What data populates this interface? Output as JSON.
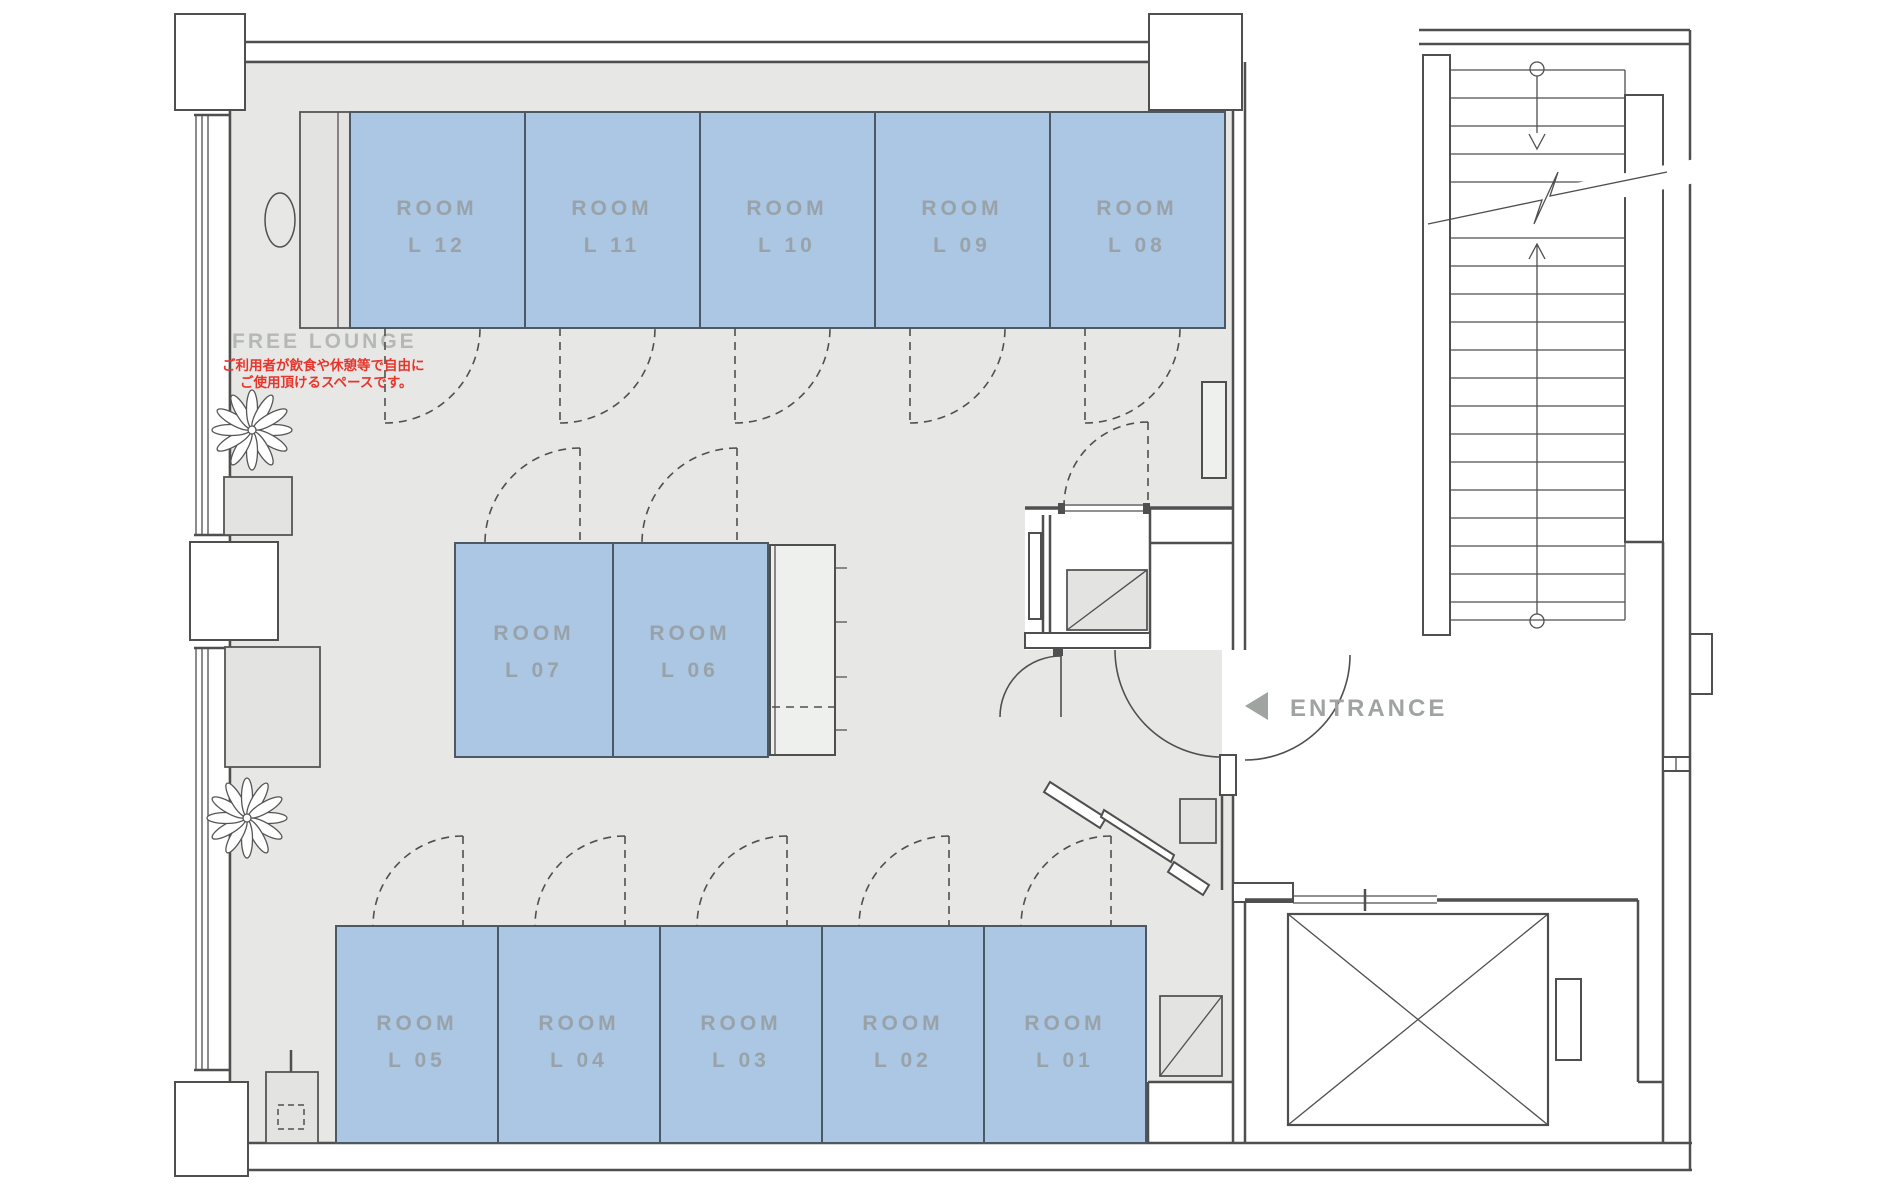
{
  "plan": {
    "type": "floor-plan",
    "free_lounge": {
      "label": "FREE LOUNGE",
      "note_line1": "ご利用者が飲食や休憩等で自由に",
      "note_line2": "ご使用頂けるスペースです。"
    },
    "entrance": {
      "label": "ENTRANCE"
    },
    "rooms": {
      "top": [
        {
          "line1": "ROOM",
          "line2": "L 12"
        },
        {
          "line1": "ROOM",
          "line2": "L 11"
        },
        {
          "line1": "ROOM",
          "line2": "L 10"
        },
        {
          "line1": "ROOM",
          "line2": "L 09"
        },
        {
          "line1": "ROOM",
          "line2": "L 08"
        }
      ],
      "middle": [
        {
          "line1": "ROOM",
          "line2": "L 07"
        },
        {
          "line1": "ROOM",
          "line2": "L 06"
        }
      ],
      "bottom": [
        {
          "line1": "ROOM",
          "line2": "L 05"
        },
        {
          "line1": "ROOM",
          "line2": "L 04"
        },
        {
          "line1": "ROOM",
          "line2": "L 03"
        },
        {
          "line1": "ROOM",
          "line2": "L 02"
        },
        {
          "line1": "ROOM",
          "line2": "L 01"
        }
      ]
    },
    "icons": {
      "entrance_arrow": "left-triangle-icon",
      "plants": "plant-icon",
      "stairs_direction": "up-down-arrow-icon",
      "elevator": "crossed-box-icon"
    },
    "colors": {
      "room_fill": "#abc7e3",
      "floor": "#e7e8e6",
      "wall": "#4f4f4f",
      "room_label": "#98a2a8",
      "lounge_label": "#b5b8b6",
      "note_red": "#e8342b",
      "entrance_gray": "#9fa4a1"
    }
  }
}
